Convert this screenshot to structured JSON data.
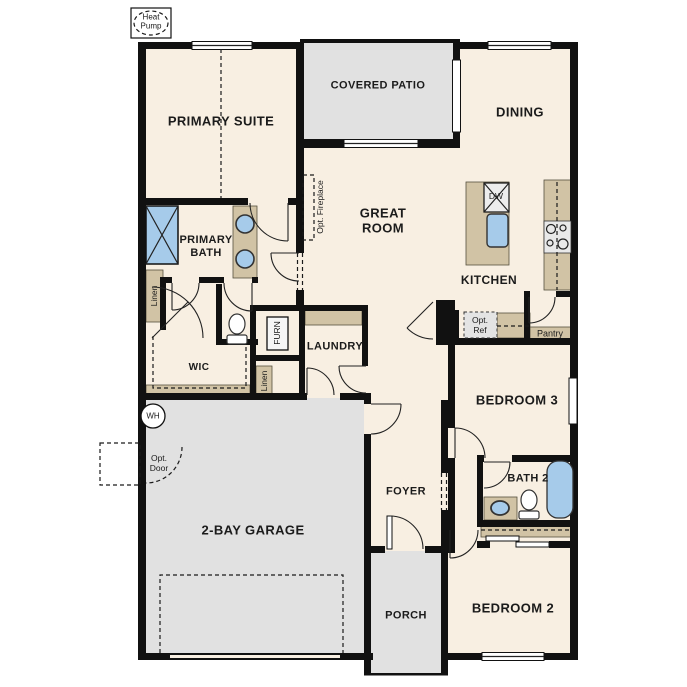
{
  "rooms": {
    "primary_suite": {
      "label": "PRIMARY SUITE"
    },
    "covered_patio": {
      "label": "COVERED PATIO"
    },
    "dining": {
      "label": "DINING"
    },
    "great_room": {
      "label": "GREAT ROOM"
    },
    "kitchen": {
      "label": "KITCHEN"
    },
    "primary_bath": {
      "label": "PRIMARY BATH"
    },
    "wic": {
      "label": "WIC"
    },
    "laundry": {
      "label": "LAUNDRY"
    },
    "pantry": {
      "label": "Pantry"
    },
    "bedroom3": {
      "label": "BEDROOM 3"
    },
    "bath2": {
      "label": "BATH 2"
    },
    "foyer": {
      "label": "FOYER"
    },
    "porch": {
      "label": "PORCH"
    },
    "bedroom2": {
      "label": "BEDROOM 2"
    },
    "garage": {
      "label": "2-BAY GARAGE"
    }
  },
  "annotations": {
    "heat_pump": "Heat Pump",
    "opt_fireplace": "Opt. Fireplace",
    "opt_ref": "Opt. Ref",
    "opt_door": "Opt. Door",
    "water_heater": "WH",
    "furnace": "FURN",
    "linen_1": "Linen",
    "linen_2": "Linen",
    "dishwasher": "DW"
  },
  "colors": {
    "interior_floor": "#f8efe2",
    "outdoor_floor": "#e1e1e1",
    "cabinetry": "#d1c3a5",
    "plumbing_fixture": "#a6cbea",
    "wall": "#111111"
  }
}
